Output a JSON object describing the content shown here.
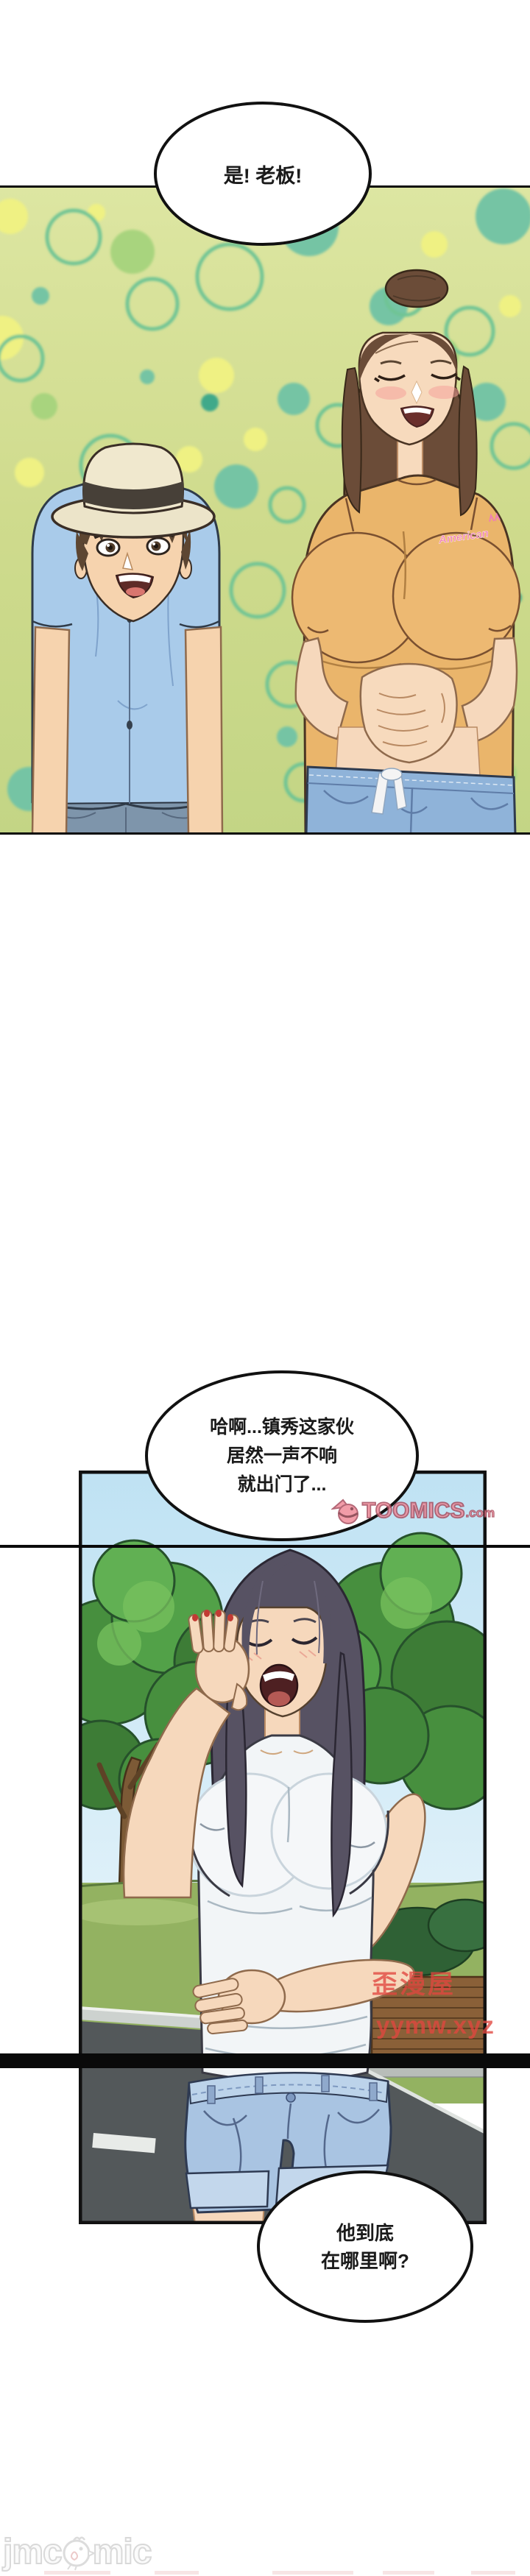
{
  "bubbles": {
    "boss": {
      "text": "是! 老板!"
    },
    "yawn": {
      "line1": "哈啊...镇秀这家伙",
      "line2": "居然一声不响",
      "line3": "就出门了..."
    },
    "where": {
      "line1": "他到底",
      "line2": "在哪里啊?"
    }
  },
  "watermarks": {
    "toomics": {
      "name": "TOOMICS",
      "domain": ".com"
    },
    "yymw": {
      "line1": "歪漫屋",
      "line2": "yymw.xyz"
    },
    "jmcomic": {
      "prefix": "jmc",
      "suffix": "mic"
    }
  },
  "panel1": {
    "shirt_logo": "American"
  },
  "colors": {
    "bubble_border": "#111111",
    "toomics_pink": "#ee8796",
    "watermark_red": "#e1473f",
    "panel1_bg": "#cfdb8d",
    "sky_blue": "#bfe2f3",
    "seam_black": "#0a0a0a"
  }
}
